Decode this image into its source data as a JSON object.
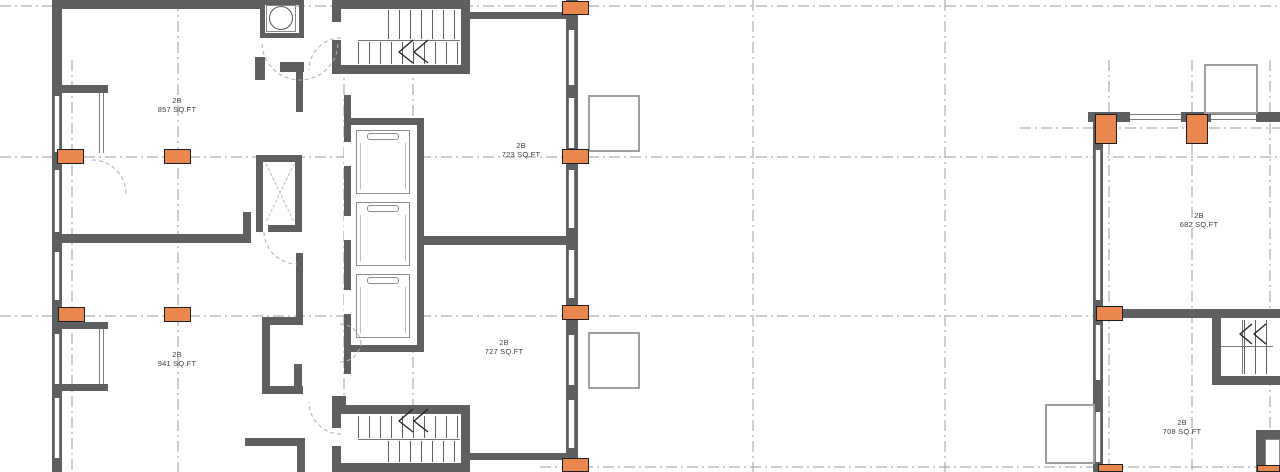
{
  "units": [
    {
      "type": "2B",
      "area": "857 SQ.FT"
    },
    {
      "type": "2B",
      "area": "723 SQ.FT"
    },
    {
      "type": "2B",
      "area": "941 SQ.FT"
    },
    {
      "type": "2B",
      "area": "727 SQ.FT"
    },
    {
      "type": "2B",
      "area": "682 SQ.FT"
    },
    {
      "type": "2B",
      "area": "708 SQ.FT"
    }
  ],
  "colors": {
    "wall": "#5e5f61",
    "column_marker": "#e9874f",
    "grid_line": "#9b9b9b",
    "balcony_line": "#9e9e9e",
    "label_text": "#3f3f3f",
    "background": "#ffffff"
  }
}
